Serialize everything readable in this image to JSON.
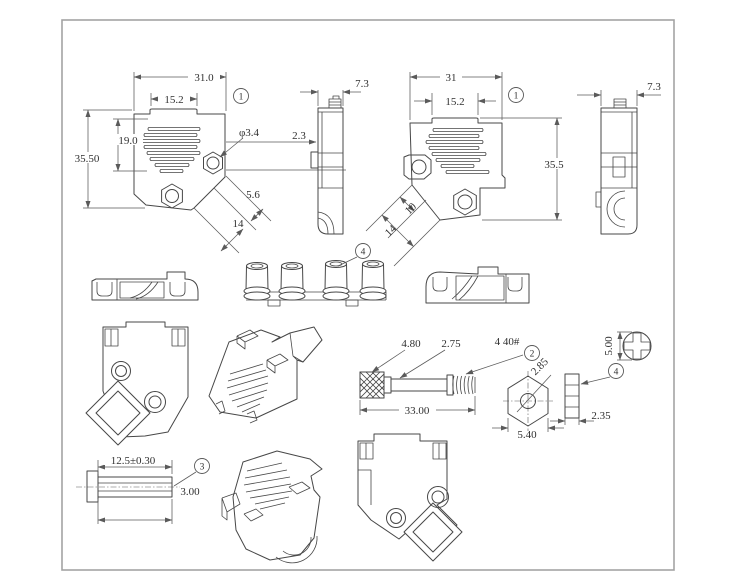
{
  "colors": {
    "background": "#ffffff",
    "frame": "#a3a3a3",
    "line": "#474747",
    "dimension": "#5a5a5a",
    "text": "#303030"
  },
  "callouts": {
    "part1": "1",
    "part2": "2",
    "part3": "3",
    "part4": "4"
  },
  "views": {
    "hood_front_left": {
      "dims": {
        "overall_width": "31.0",
        "top_slot_width": "15.2",
        "vent_height": "19.0",
        "overall_height": "35.50",
        "screw_hole_dia": "φ3.4",
        "side_step": "2.3",
        "exit_offset": "5.6",
        "exit_width": "14"
      }
    },
    "hood_side_left": {
      "dims": {
        "depth": "7.3"
      }
    },
    "hood_front_right": {
      "dims": {
        "overall_width": "31",
        "top_slot_width": "15.2",
        "overall_height": "35.5",
        "exit_offset": "10",
        "exit_width": "14"
      }
    },
    "hood_side_right": {
      "dims": {
        "depth": "7.3"
      }
    },
    "thumbscrew": {
      "dims": {
        "head_dia": "4.80",
        "shaft_dia": "2.75",
        "thread_spec": "4 40#",
        "overall_length": "33.00"
      }
    },
    "hex_nut": {
      "dims": {
        "bore_dia": "2.85",
        "across_flats": "5.40"
      }
    },
    "screw_lock_post": {
      "dims": {
        "head_dia": "5.00",
        "body_width": "2.35"
      }
    },
    "slotted_pin": {
      "dims": {
        "length": "12.5±0.30",
        "dia": "3.00"
      }
    }
  }
}
